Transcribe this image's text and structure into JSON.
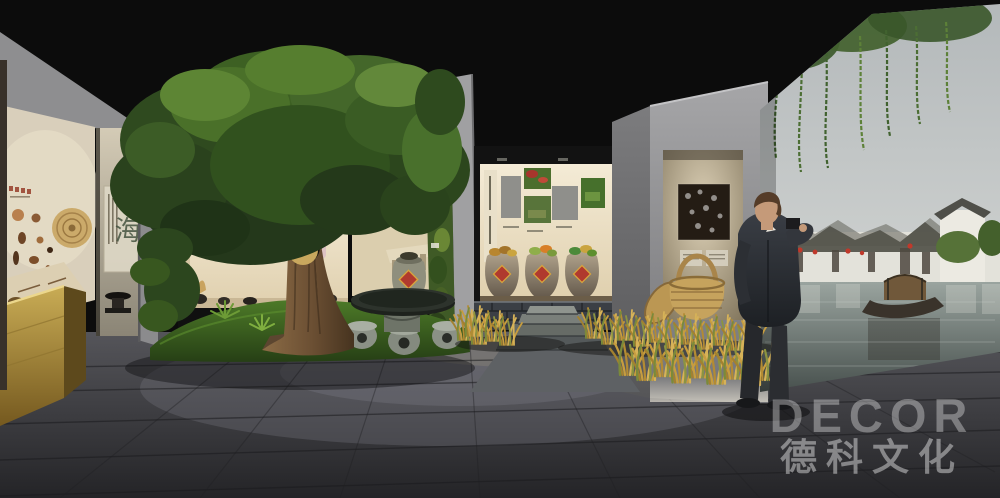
{
  "scene": {
    "description": "3D concept render of a folk-culture exhibition hall: indoor tree, artifact display windows, rice-grass planting, stone table, and a water-town photo mural with a visitor",
    "watermark": {
      "logo": "DECOR",
      "company": "德科文化"
    },
    "left_gallery": {
      "calligraphy_character": "海"
    },
    "colors": {
      "ceiling": "#0c0c0c",
      "floor": "#3a3a3e",
      "gray_wall": "#98989a",
      "beige_panel": "#d9cfbb",
      "display_case_gold": "#b99c4a",
      "foliage_green": "#3d5c24",
      "grass_green": "#3f6d23",
      "rice_gold": "#c49a3c",
      "accent_red": "#b03a2e",
      "mural_sky": "#bcc0c0",
      "mural_water": "#6d7a76",
      "suit_navy": "#2b2e34",
      "watermark_white": "rgba(255,255,255,0.4)"
    }
  }
}
